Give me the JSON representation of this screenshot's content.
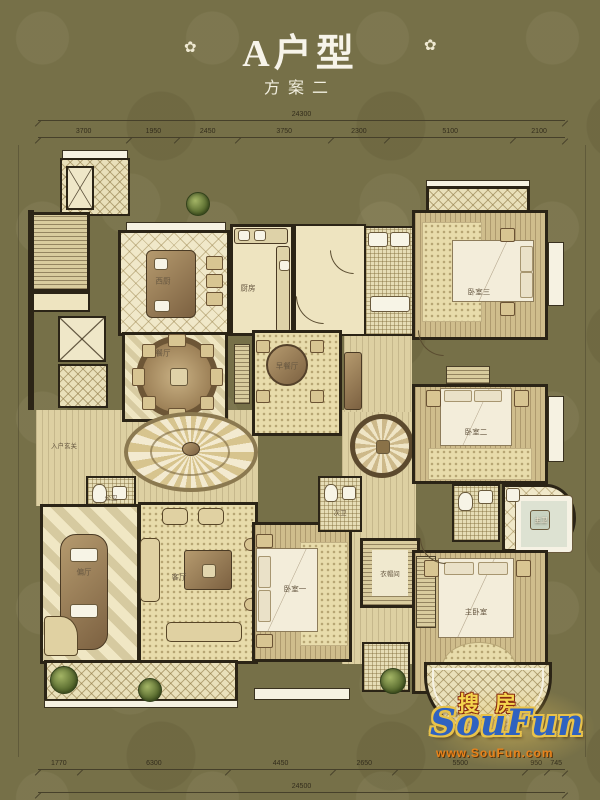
{
  "title": {
    "main": "A户型",
    "sub": "方案二"
  },
  "icons": {
    "flourish": "✿"
  },
  "dims": {
    "top_total": "24300",
    "top_segments": [
      "3700",
      "1950",
      "2450",
      "3750",
      "2300",
      "5100",
      "2100"
    ],
    "bottom_segments": [
      "1770",
      "6300",
      "4450",
      "2650",
      "5500",
      "950",
      "745"
    ],
    "bottom_total": "24500"
  },
  "rooms": {
    "west_kitchen": "西厨",
    "kitchen": "厨房",
    "dining": "餐厅",
    "breakfast": "早餐厅",
    "foyer": "入户玄关",
    "guest_bath": "公卫",
    "side_hall": "偏厅",
    "living": "客厅",
    "bedroom1": "卧室一",
    "bedroom2": "卧室二",
    "bedroom3": "卧室三",
    "master": "主卧室",
    "closet": "衣帽间",
    "second_bath": "次卫",
    "master_bath": "主卫"
  },
  "watermark": {
    "cn": "搜房",
    "en": "SouFun",
    "url": "www.SouFun.com"
  },
  "colors": {
    "bg": "#767048",
    "wall": "#2b2416",
    "floor": "#eee4c0",
    "wm_blue": "#2f62c0",
    "wm_gold": "#e8c24a",
    "wm_orange": "#e8821a"
  }
}
